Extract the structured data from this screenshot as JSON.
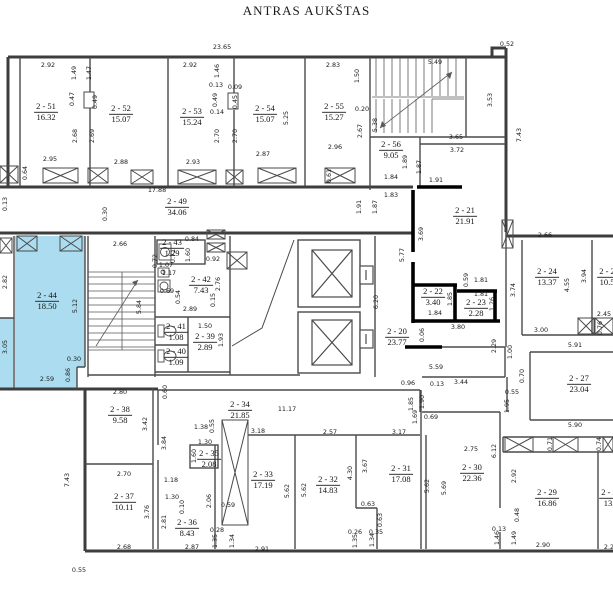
{
  "title": "ANTRAS AUKŠTAS",
  "plan": {
    "highlight_color": "#abdcef",
    "rooms": [
      {
        "n": "2 - 51",
        "a": "16.32",
        "x": 46,
        "y": 112
      },
      {
        "n": "2 - 52",
        "a": "15.07",
        "x": 121,
        "y": 114
      },
      {
        "n": "2 - 53",
        "a": "15.24",
        "x": 192,
        "y": 117
      },
      {
        "n": "2 - 54",
        "a": "15.07",
        "x": 265,
        "y": 114
      },
      {
        "n": "2 - 55",
        "a": "15.27",
        "x": 334,
        "y": 112
      },
      {
        "n": "2 - 56",
        "a": "9.05",
        "x": 391,
        "y": 150
      },
      {
        "n": "2 - 49",
        "a": "34.06",
        "x": 177,
        "y": 207
      },
      {
        "n": "2 - 21",
        "a": "21.91",
        "x": 465,
        "y": 216
      },
      {
        "n": "2 - 24",
        "a": "13.37",
        "x": 547,
        "y": 277
      },
      {
        "n": "2 - 2",
        "a": "10.5",
        "x": 607,
        "y": 277
      },
      {
        "n": "2 - 22",
        "a": "3.40",
        "x": 433,
        "y": 297
      },
      {
        "n": "2 - 23",
        "a": "2.28",
        "x": 476,
        "y": 308
      },
      {
        "n": "2 - 20",
        "a": "23.77",
        "x": 397,
        "y": 337
      },
      {
        "n": "2 - 27",
        "a": "23.04",
        "x": 579,
        "y": 384
      },
      {
        "n": "2 - 44",
        "a": "18.50",
        "x": 47,
        "y": 301,
        "hl": true
      },
      {
        "n": "2 - 43",
        "a": "1.29",
        "x": 172,
        "y": 248
      },
      {
        "n": "2 - 42",
        "a": "7.43",
        "x": 201,
        "y": 285
      },
      {
        "n": "2 - 41",
        "a": "1.08",
        "x": 176,
        "y": 332
      },
      {
        "n": "2 - 39",
        "a": "2.89",
        "x": 205,
        "y": 342
      },
      {
        "n": "2 - 40",
        "a": "1.09",
        "x": 176,
        "y": 357
      },
      {
        "n": "2 - 38",
        "a": "9.58",
        "x": 120,
        "y": 415
      },
      {
        "n": "2 - 34",
        "a": "21.85",
        "x": 240,
        "y": 410
      },
      {
        "n": "2 - 35",
        "a": "2.08",
        "x": 209,
        "y": 459
      },
      {
        "n": "2 - 37",
        "a": "10.11",
        "x": 124,
        "y": 502
      },
      {
        "n": "2 - 36",
        "a": "8.43",
        "x": 187,
        "y": 528
      },
      {
        "n": "2 - 33",
        "a": "17.19",
        "x": 263,
        "y": 480
      },
      {
        "n": "2 - 32",
        "a": "14.83",
        "x": 328,
        "y": 485
      },
      {
        "n": "2 - 31",
        "a": "17.08",
        "x": 401,
        "y": 474
      },
      {
        "n": "2 - 30",
        "a": "22.36",
        "x": 472,
        "y": 473
      },
      {
        "n": "2 - 29",
        "a": "16.86",
        "x": 547,
        "y": 498
      },
      {
        "n": "2 - 2",
        "a": "13.",
        "x": 609,
        "y": 498
      }
    ],
    "dims": [
      {
        "t": "23.65",
        "x": 222,
        "y": 47
      },
      {
        "t": "0.52",
        "x": 507,
        "y": 44
      },
      {
        "t": "2.92",
        "x": 48,
        "y": 65
      },
      {
        "t": "2.92",
        "x": 190,
        "y": 65
      },
      {
        "t": "2.83",
        "x": 333,
        "y": 65
      },
      {
        "t": "5.49",
        "x": 435,
        "y": 62
      },
      {
        "t": "1.49",
        "x": 74,
        "y": 73,
        "v": 1
      },
      {
        "t": "1.47",
        "x": 89,
        "y": 73,
        "v": 1
      },
      {
        "t": "1.46",
        "x": 217,
        "y": 71,
        "v": 1
      },
      {
        "t": "1.50",
        "x": 357,
        "y": 76,
        "v": 1
      },
      {
        "t": "0.13",
        "x": 216,
        "y": 85
      },
      {
        "t": "0.09",
        "x": 235,
        "y": 87
      },
      {
        "t": "0.47",
        "x": 72,
        "y": 99,
        "v": 1
      },
      {
        "t": "0.49",
        "x": 95,
        "y": 102,
        "v": 1
      },
      {
        "t": "0.49",
        "x": 215,
        "y": 100,
        "v": 1
      },
      {
        "t": "0.45",
        "x": 235,
        "y": 102,
        "v": 1
      },
      {
        "t": "0.14",
        "x": 217,
        "y": 112
      },
      {
        "t": "0.20",
        "x": 362,
        "y": 109
      },
      {
        "t": "3.53",
        "x": 490,
        "y": 100,
        "v": 1
      },
      {
        "t": "2.68",
        "x": 75,
        "y": 136,
        "v": 1
      },
      {
        "t": "2.69",
        "x": 92,
        "y": 136,
        "v": 1
      },
      {
        "t": "2.70",
        "x": 217,
        "y": 136,
        "v": 1
      },
      {
        "t": "2.70",
        "x": 235,
        "y": 136,
        "v": 1
      },
      {
        "t": "5.25",
        "x": 286,
        "y": 118,
        "v": 1
      },
      {
        "t": "5.38",
        "x": 375,
        "y": 125,
        "v": 1
      },
      {
        "t": "2.67",
        "x": 360,
        "y": 131,
        "v": 1
      },
      {
        "t": "7.43",
        "x": 519,
        "y": 135,
        "v": 1
      },
      {
        "t": "2.95",
        "x": 50,
        "y": 159
      },
      {
        "t": "2.88",
        "x": 121,
        "y": 162
      },
      {
        "t": "2.93",
        "x": 193,
        "y": 162
      },
      {
        "t": "2.87",
        "x": 263,
        "y": 154
      },
      {
        "t": "2.96",
        "x": 335,
        "y": 147
      },
      {
        "t": "3.65",
        "x": 456,
        "y": 137
      },
      {
        "t": "3.72",
        "x": 457,
        "y": 150
      },
      {
        "t": "0.64",
        "x": 25,
        "y": 173,
        "v": 1
      },
      {
        "t": "0.61",
        "x": 329,
        "y": 176,
        "v": 1
      },
      {
        "t": "1.89",
        "x": 405,
        "y": 162,
        "v": 1
      },
      {
        "t": "1.87",
        "x": 419,
        "y": 167,
        "v": 1
      },
      {
        "t": "1.84",
        "x": 391,
        "y": 177
      },
      {
        "t": "1.91",
        "x": 436,
        "y": 180
      },
      {
        "t": "17.88",
        "x": 157,
        "y": 190
      },
      {
        "t": "1.83",
        "x": 391,
        "y": 195
      },
      {
        "t": "0.13",
        "x": 5,
        "y": 204,
        "v": 1
      },
      {
        "t": "1.91",
        "x": 359,
        "y": 207,
        "v": 1
      },
      {
        "t": "1.87",
        "x": 375,
        "y": 207,
        "v": 1
      },
      {
        "t": "0.30",
        "x": 105,
        "y": 214,
        "v": 1
      },
      {
        "t": "2.66",
        "x": 120,
        "y": 244
      },
      {
        "t": "0.84",
        "x": 192,
        "y": 239
      },
      {
        "t": "1.60",
        "x": 188,
        "y": 255,
        "v": 1
      },
      {
        "t": "0.92",
        "x": 213,
        "y": 259
      },
      {
        "t": "0.72",
        "x": 155,
        "y": 261,
        "v": 1
      },
      {
        "t": "0.71",
        "x": 173,
        "y": 256,
        "v": 1
      },
      {
        "t": "1.07",
        "x": 166,
        "y": 265
      },
      {
        "t": "1.17",
        "x": 169,
        "y": 273
      },
      {
        "t": "0.69",
        "x": 167,
        "y": 291
      },
      {
        "t": "0.54",
        "x": 178,
        "y": 297,
        "v": 1
      },
      {
        "t": "2.76",
        "x": 218,
        "y": 284,
        "v": 1
      },
      {
        "t": "0.15",
        "x": 213,
        "y": 300,
        "v": 1
      },
      {
        "t": "2.89",
        "x": 190,
        "y": 309
      },
      {
        "t": "1.50",
        "x": 205,
        "y": 326
      },
      {
        "t": "1.93",
        "x": 221,
        "y": 340,
        "v": 1
      },
      {
        "t": "5.12",
        "x": 75,
        "y": 306,
        "v": 1
      },
      {
        "t": "2.82",
        "x": 5,
        "y": 282,
        "v": 1
      },
      {
        "t": "3.05",
        "x": 5,
        "y": 347,
        "v": 1
      },
      {
        "t": "5.84",
        "x": 139,
        "y": 307,
        "v": 1
      },
      {
        "t": "0.30",
        "x": 74,
        "y": 359
      },
      {
        "t": "2.59",
        "x": 47,
        "y": 379
      },
      {
        "t": "0.86",
        "x": 68,
        "y": 375,
        "v": 1
      },
      {
        "t": "2.66",
        "x": 545,
        "y": 235
      },
      {
        "t": "3.69",
        "x": 421,
        "y": 234,
        "v": 1
      },
      {
        "t": "5.77",
        "x": 402,
        "y": 255,
        "v": 1
      },
      {
        "t": "6.20",
        "x": 376,
        "y": 302,
        "v": 1
      },
      {
        "t": "0.59",
        "x": 466,
        "y": 280,
        "v": 1
      },
      {
        "t": "1.81",
        "x": 481,
        "y": 280
      },
      {
        "t": "1.81",
        "x": 481,
        "y": 294
      },
      {
        "t": "1.85",
        "x": 450,
        "y": 299,
        "v": 1
      },
      {
        "t": "1.26",
        "x": 492,
        "y": 304,
        "v": 1
      },
      {
        "t": "1.84",
        "x": 435,
        "y": 313
      },
      {
        "t": "3.74",
        "x": 513,
        "y": 290,
        "v": 1
      },
      {
        "t": "4.55",
        "x": 567,
        "y": 285,
        "v": 1
      },
      {
        "t": "3.94",
        "x": 584,
        "y": 276,
        "v": 1
      },
      {
        "t": "3.80",
        "x": 458,
        "y": 327
      },
      {
        "t": "3.00",
        "x": 541,
        "y": 330
      },
      {
        "t": "2.45",
        "x": 604,
        "y": 314
      },
      {
        "t": "0.76",
        "x": 600,
        "y": 328,
        "v": 1
      },
      {
        "t": "0.06",
        "x": 422,
        "y": 335,
        "v": 1
      },
      {
        "t": "2.29",
        "x": 494,
        "y": 346,
        "v": 1
      },
      {
        "t": "1.00",
        "x": 510,
        "y": 352,
        "v": 1
      },
      {
        "t": "5.91",
        "x": 575,
        "y": 345
      },
      {
        "t": "5.59",
        "x": 436,
        "y": 367
      },
      {
        "t": "0.70",
        "x": 522,
        "y": 376,
        "v": 1
      },
      {
        "t": "0.96",
        "x": 408,
        "y": 383
      },
      {
        "t": "0.13",
        "x": 437,
        "y": 384
      },
      {
        "t": "3.44",
        "x": 461,
        "y": 382
      },
      {
        "t": "0.55",
        "x": 512,
        "y": 392
      },
      {
        "t": "2.80",
        "x": 120,
        "y": 392
      },
      {
        "t": "0.60",
        "x": 165,
        "y": 392,
        "v": 1
      },
      {
        "t": "1.90",
        "x": 422,
        "y": 402,
        "v": 1
      },
      {
        "t": "1.85",
        "x": 411,
        "y": 404,
        "v": 1
      },
      {
        "t": "1.69",
        "x": 415,
        "y": 417,
        "v": 1
      },
      {
        "t": "1.95",
        "x": 507,
        "y": 406,
        "v": 1
      },
      {
        "t": "0.69",
        "x": 431,
        "y": 417
      },
      {
        "t": "11.17",
        "x": 287,
        "y": 409
      },
      {
        "t": "3.42",
        "x": 145,
        "y": 424,
        "v": 1
      },
      {
        "t": "0.55",
        "x": 212,
        "y": 426,
        "v": 1
      },
      {
        "t": "1.38",
        "x": 201,
        "y": 427
      },
      {
        "t": "3.18",
        "x": 258,
        "y": 431
      },
      {
        "t": "2.57",
        "x": 330,
        "y": 432
      },
      {
        "t": "3.17",
        "x": 399,
        "y": 432
      },
      {
        "t": "5.90",
        "x": 575,
        "y": 425
      },
      {
        "t": "1.30",
        "x": 205,
        "y": 442
      },
      {
        "t": "1.60",
        "x": 194,
        "y": 456,
        "v": 1
      },
      {
        "t": "3.84",
        "x": 164,
        "y": 443,
        "v": 1
      },
      {
        "t": "0.71",
        "x": 550,
        "y": 444,
        "v": 1
      },
      {
        "t": "0.74",
        "x": 599,
        "y": 444,
        "v": 1
      },
      {
        "t": "2.75",
        "x": 471,
        "y": 449
      },
      {
        "t": "2.70",
        "x": 124,
        "y": 474
      },
      {
        "t": "1.18",
        "x": 171,
        "y": 480
      },
      {
        "t": "1.30",
        "x": 172,
        "y": 497
      },
      {
        "t": "0.10",
        "x": 182,
        "y": 507,
        "v": 1
      },
      {
        "t": "2.06",
        "x": 209,
        "y": 501,
        "v": 1
      },
      {
        "t": "0.59",
        "x": 228,
        "y": 505
      },
      {
        "t": "3.76",
        "x": 147,
        "y": 512,
        "v": 1
      },
      {
        "t": "2.81",
        "x": 164,
        "y": 522,
        "v": 1
      },
      {
        "t": "0.63",
        "x": 368,
        "y": 504
      },
      {
        "t": "0.63",
        "x": 380,
        "y": 520,
        "v": 1
      },
      {
        "t": "4.30",
        "x": 350,
        "y": 473,
        "v": 1
      },
      {
        "t": "3.67",
        "x": 365,
        "y": 466,
        "v": 1
      },
      {
        "t": "5.62",
        "x": 287,
        "y": 491,
        "v": 1
      },
      {
        "t": "5.62",
        "x": 304,
        "y": 490,
        "v": 1
      },
      {
        "t": "5.62",
        "x": 427,
        "y": 486,
        "v": 1
      },
      {
        "t": "5.69",
        "x": 444,
        "y": 488,
        "v": 1
      },
      {
        "t": "6.12",
        "x": 494,
        "y": 451,
        "v": 1
      },
      {
        "t": "2.92",
        "x": 514,
        "y": 476,
        "v": 1
      },
      {
        "t": "0.48",
        "x": 517,
        "y": 515,
        "v": 1
      },
      {
        "t": "0.13",
        "x": 499,
        "y": 529
      },
      {
        "t": "1.46",
        "x": 497,
        "y": 538,
        "v": 1
      },
      {
        "t": "1.49",
        "x": 514,
        "y": 538,
        "v": 1
      },
      {
        "t": "0.28",
        "x": 217,
        "y": 530
      },
      {
        "t": "1.35",
        "x": 215,
        "y": 541,
        "v": 1
      },
      {
        "t": "1.34",
        "x": 232,
        "y": 541,
        "v": 1
      },
      {
        "t": "0.26",
        "x": 355,
        "y": 532
      },
      {
        "t": "0.35",
        "x": 376,
        "y": 532
      },
      {
        "t": "1.35",
        "x": 355,
        "y": 541,
        "v": 1
      },
      {
        "t": "1.34",
        "x": 372,
        "y": 540,
        "v": 1
      },
      {
        "t": "2.68",
        "x": 124,
        "y": 547
      },
      {
        "t": "2.87",
        "x": 192,
        "y": 547
      },
      {
        "t": "2.91",
        "x": 262,
        "y": 549
      },
      {
        "t": "2.90",
        "x": 543,
        "y": 545
      },
      {
        "t": "2.2",
        "x": 609,
        "y": 547
      },
      {
        "t": "0.55",
        "x": 79,
        "y": 570
      },
      {
        "t": "7.43",
        "x": 67,
        "y": 480,
        "v": 1
      }
    ]
  }
}
